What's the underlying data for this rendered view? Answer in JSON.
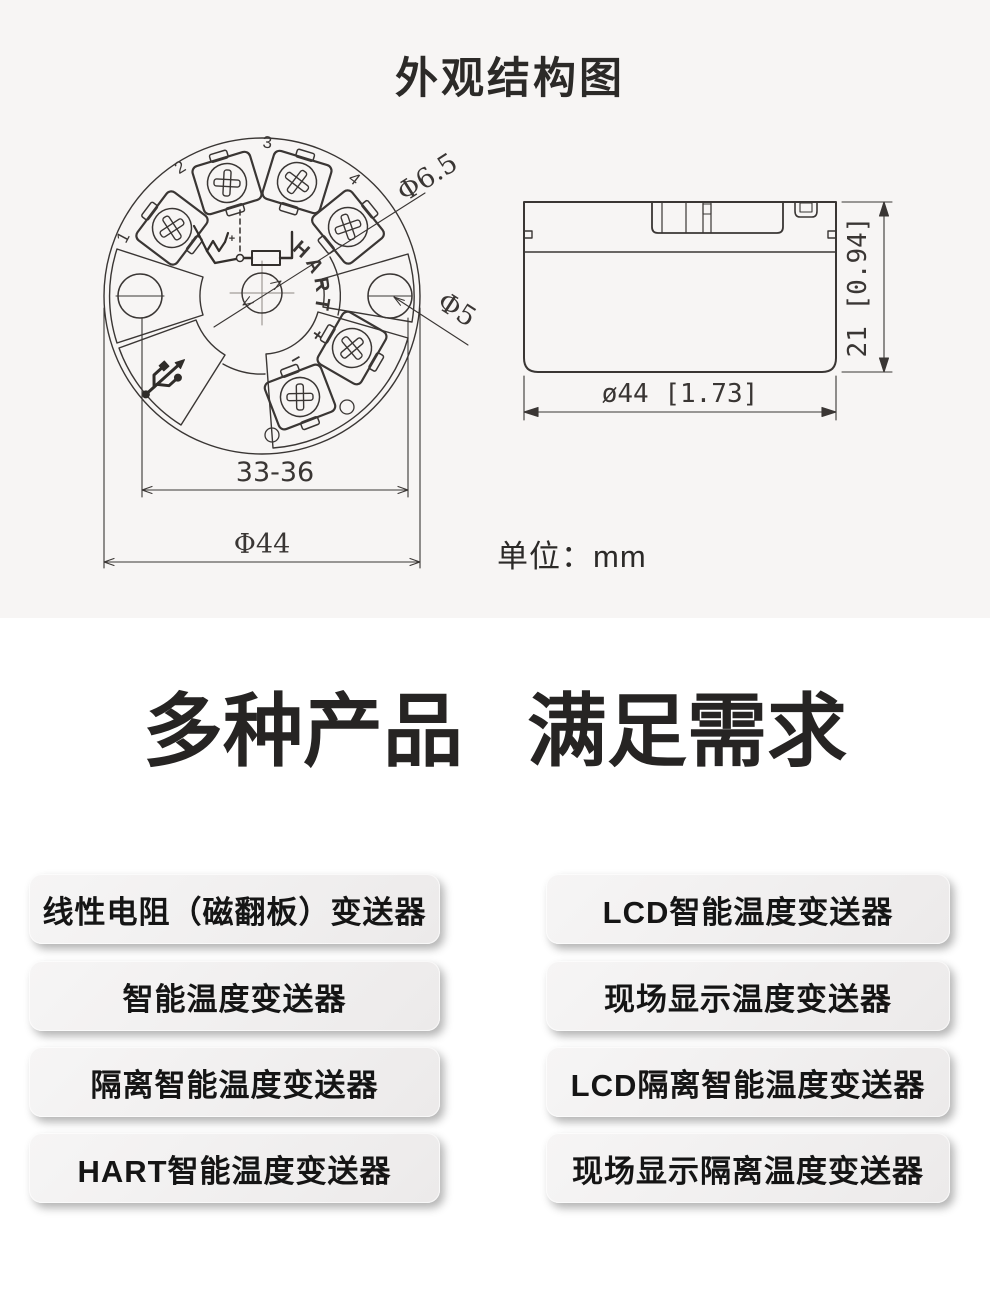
{
  "diagram": {
    "title": "外观结构图",
    "unit_label": "单位：mm",
    "top_view": {
      "terminal_numbers": [
        "1",
        "2",
        "3",
        "4"
      ],
      "hart_label": "HART",
      "hart_plus": "+",
      "hart_minus": "−",
      "wiring_minus": "-",
      "wiring_plus": "+",
      "dim_span": "33-36",
      "dim_outer_diameter": "Φ44",
      "dim_hole_large": "Φ6.5",
      "dim_hole_small": "Φ5"
    },
    "side_view": {
      "dim_width": "ø44 [1.73]",
      "dim_height": "21 [0.94]"
    }
  },
  "headline": {
    "part1": "多种产品",
    "part2": "满足需求"
  },
  "products": {
    "left_column": [
      "线性电阻（磁翻板）变送器",
      "智能温度变送器",
      "隔离智能温度变送器",
      "HART智能温度变送器"
    ],
    "right_column": [
      "LCD智能温度变送器",
      "现场显示温度变送器",
      "LCD隔离智能温度变送器",
      "现场显示隔离温度变送器"
    ]
  },
  "colors": {
    "top_background": "#f7f5f4",
    "line": "#3a3634",
    "heading_text": "#262423",
    "button_text": "#151515"
  }
}
